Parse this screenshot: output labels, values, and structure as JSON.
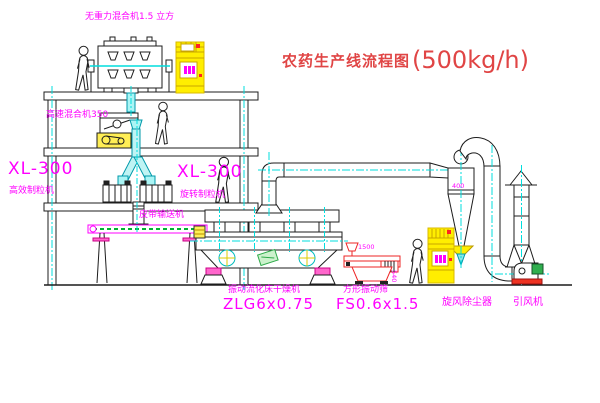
{
  "title": {
    "name": "农药生产线流程图",
    "capacity": "(500kg/h)"
  },
  "labels": {
    "gravity_free_mixer": "无重力混合机1.5 立方",
    "high_speed_mixer": "高速混合机350",
    "granulator_left_model": "XL-300",
    "granulator_left_name": "高效制粒机",
    "granulator_center_model": "XL-300",
    "granulator_center_name": "旋转制粒机",
    "belt_conveyor": "皮带输送机",
    "dryer_name": "振动流化床干燥机",
    "dryer_model": "ZLG6x0.75",
    "sieve_name": "方形振动筛",
    "sieve_model": "FS0.6x1.5",
    "cyclone_name": "旋风除尘器",
    "fan_name": "引风机"
  },
  "dimensions": {
    "cyclone_size": "400",
    "sieve_length": "1500",
    "sieve_height": "540"
  },
  "colors": {
    "label_magenta": "#ff00ff",
    "title_red": "#e04545",
    "line_black": "#1c1c1c",
    "centerline_cyan": "#00dede",
    "equipment_yellow": "#ffee00",
    "sieve_red": "#ee2525",
    "belt_green": "#00b133"
  }
}
